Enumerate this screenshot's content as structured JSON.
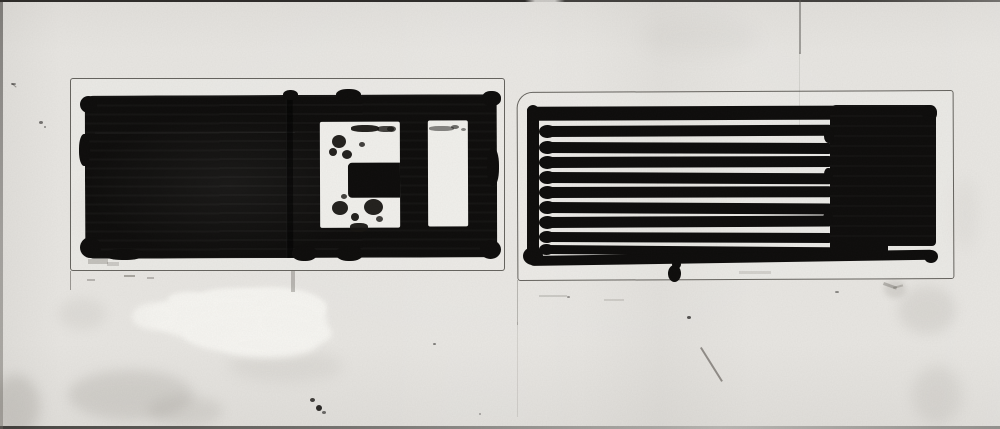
{
  "artwork": {
    "type": "scanned ink drawing",
    "description": "Black ink study on stained paper: two pencil-ruled panels. Left panel is a solid black rectangle with a white bracket-shaped cutout and a white vertical bar. Right panel is a comb of eleven horizontal ink stripes with a solid black block at the right end. White-out splotch and gray smudges below the left panel.",
    "colors": {
      "paper": "#e8e6e2",
      "paper_bright": "#f1f0ec",
      "white_out": "#f7f6f2",
      "ink": "#0d0c0b",
      "pencil": "#38352f"
    },
    "crease": {
      "x": 799,
      "y": 0,
      "w": 2,
      "h": 54
    },
    "left_panel": {
      "pencil_box": {
        "x": 70,
        "y": 78,
        "w": 435,
        "h": 193
      },
      "ink_rect": {
        "x": 85,
        "y": 95,
        "w": 412,
        "h": 163,
        "tilt": -0.2
      },
      "cutout_bracket": {
        "x": 235,
        "y": 27,
        "w": 80,
        "h": 106
      },
      "cutout_bracket_notch": {
        "x": 28,
        "y": 41,
        "w": 52,
        "h": 35
      },
      "cutout_bar": {
        "x": 343,
        "y": 26,
        "w": 40,
        "h": 106
      },
      "seam": {
        "x": 201,
        "y": 0,
        "w": 7,
        "h": 163
      },
      "seam_highlight": {
        "x": 10,
        "y": 37,
        "w": 200,
        "h": 1
      }
    },
    "right_panel": {
      "pencil_box": {
        "x": 517,
        "y": 91,
        "w": 437,
        "h": 189
      },
      "vertical_bar": {
        "x": 527,
        "y": 105,
        "w": 12,
        "h": 158
      },
      "top_stripe": {
        "x": 527,
        "y": 106,
        "w": 409,
        "h": 14,
        "tilt": -0.2
      },
      "block": {
        "x": 830,
        "y": 105,
        "w": 106,
        "h": 141
      },
      "bottom_stripe": {
        "x": 529,
        "y": 256,
        "w": 406,
        "h": 10,
        "tilt": -0.9
      },
      "stripe_x": 542,
      "stripe_w": 292,
      "stripe_count_total": 11,
      "stripes": [
        {
          "y": 126,
          "h": 11,
          "tilt": -0.25
        },
        {
          "y": 142,
          "h": 11,
          "tilt": 0.2
        },
        {
          "y": 157,
          "h": 11,
          "tilt": -0.2
        },
        {
          "y": 172,
          "h": 11,
          "tilt": 0.25
        },
        {
          "y": 187,
          "h": 11,
          "tilt": -0.15
        },
        {
          "y": 202,
          "h": 11,
          "tilt": 0.3
        },
        {
          "y": 217,
          "h": 11,
          "tilt": -0.3
        },
        {
          "y": 232,
          "h": 10,
          "tilt": 0.2
        },
        {
          "y": 245,
          "h": 9,
          "tilt": 0.45
        }
      ]
    },
    "ink_marks": [
      {
        "x": 80,
        "y": 96,
        "w": 17,
        "h": 17
      },
      {
        "x": 79,
        "y": 134,
        "w": 11,
        "h": 32,
        "r": "45%"
      },
      {
        "x": 80,
        "y": 237,
        "w": 21,
        "h": 21
      },
      {
        "x": 104,
        "y": 249,
        "w": 40,
        "h": 11,
        "r": "45%"
      },
      {
        "x": 283,
        "y": 90,
        "w": 15,
        "h": 10,
        "r": "45%"
      },
      {
        "x": 336,
        "y": 89,
        "w": 25,
        "h": 12,
        "r": "45%"
      },
      {
        "x": 482,
        "y": 91,
        "w": 19,
        "h": 15,
        "r": "45%"
      },
      {
        "x": 487,
        "y": 148,
        "w": 12,
        "h": 38,
        "r": "45%"
      },
      {
        "x": 480,
        "y": 240,
        "w": 21,
        "h": 19
      },
      {
        "x": 292,
        "y": 246,
        "w": 25,
        "h": 15,
        "r": "45%"
      },
      {
        "x": 336,
        "y": 246,
        "w": 27,
        "h": 15,
        "r": "45%"
      },
      {
        "x": 523,
        "y": 247,
        "w": 20,
        "h": 18
      },
      {
        "x": 922,
        "y": 105,
        "w": 15,
        "h": 16,
        "r": "45%"
      },
      {
        "x": 924,
        "y": 250,
        "w": 14,
        "h": 13
      },
      {
        "x": 824,
        "y": 128,
        "w": 10,
        "h": 15,
        "r": "45%"
      },
      {
        "x": 824,
        "y": 168,
        "w": 9,
        "h": 13,
        "r": "45%"
      },
      {
        "x": 823,
        "y": 212,
        "w": 10,
        "h": 13,
        "r": "45%"
      },
      {
        "x": 830,
        "y": 240,
        "w": 58,
        "h": 17,
        "r": "3px"
      },
      {
        "x": 668,
        "y": 265,
        "w": 13,
        "h": 17
      },
      {
        "x": 672,
        "y": 260,
        "w": 9,
        "h": 9
      }
    ],
    "specks": [
      {
        "x": 351,
        "y": 125,
        "w": 28,
        "h": 7,
        "r": "40%"
      },
      {
        "x": 377,
        "y": 126,
        "w": 17,
        "h": 6,
        "r": "40%",
        "o": 0.8
      },
      {
        "x": 332,
        "y": 135,
        "w": 14,
        "h": 13
      },
      {
        "x": 329,
        "y": 148,
        "w": 8,
        "h": 8
      },
      {
        "x": 342,
        "y": 150,
        "w": 10,
        "h": 9
      },
      {
        "x": 359,
        "y": 142,
        "w": 6,
        "h": 5,
        "o": 0.8
      },
      {
        "x": 387,
        "y": 126,
        "w": 9,
        "h": 6,
        "o": 0.75
      },
      {
        "x": 332,
        "y": 201,
        "w": 16,
        "h": 14
      },
      {
        "x": 364,
        "y": 199,
        "w": 19,
        "h": 16
      },
      {
        "x": 351,
        "y": 213,
        "w": 8,
        "h": 8
      },
      {
        "x": 341,
        "y": 194,
        "w": 6,
        "h": 5,
        "o": 0.8
      },
      {
        "x": 376,
        "y": 216,
        "w": 7,
        "h": 6,
        "o": 0.8
      },
      {
        "x": 350,
        "y": 223,
        "w": 18,
        "h": 9,
        "r": "40%"
      },
      {
        "x": 429,
        "y": 126,
        "w": 25,
        "h": 5,
        "r": "40%",
        "o": 0.5
      },
      {
        "x": 451,
        "y": 125,
        "w": 8,
        "h": 4,
        "o": 0.6
      },
      {
        "x": 461,
        "y": 128,
        "w": 5,
        "h": 3,
        "o": 0.5
      },
      {
        "x": 310,
        "y": 398,
        "w": 5,
        "h": 4,
        "o": 0.8
      },
      {
        "x": 316,
        "y": 405,
        "w": 6,
        "h": 6,
        "o": 0.9
      },
      {
        "x": 322,
        "y": 411,
        "w": 4,
        "h": 3,
        "o": 0.6
      },
      {
        "x": 433,
        "y": 343,
        "w": 3,
        "h": 2,
        "o": 0.5
      },
      {
        "x": 687,
        "y": 316,
        "w": 4,
        "h": 3,
        "o": 0.7
      },
      {
        "x": 835,
        "y": 291,
        "w": 4,
        "h": 2,
        "o": 0.45
      },
      {
        "x": 567,
        "y": 296,
        "w": 3,
        "h": 2,
        "o": 0.4
      },
      {
        "x": 39,
        "y": 121,
        "w": 4,
        "h": 3,
        "o": 0.55
      },
      {
        "x": 44,
        "y": 126,
        "w": 2,
        "h": 2,
        "o": 0.45
      },
      {
        "x": 11,
        "y": 83,
        "w": 5,
        "h": 2,
        "o": 0.5
      },
      {
        "x": 479,
        "y": 413,
        "w": 2,
        "h": 2,
        "o": 0.35
      }
    ],
    "pencil_marks": [
      {
        "x": 700,
        "y": 348,
        "w": 2,
        "h": 40,
        "rot": -32,
        "o": 0.55
      },
      {
        "x": 124,
        "y": 275,
        "w": 11,
        "h": 2,
        "o": 0.4
      },
      {
        "x": 147,
        "y": 277,
        "w": 7,
        "h": 2,
        "o": 0.3
      },
      {
        "x": 87,
        "y": 279,
        "w": 8,
        "h": 2,
        "o": 0.3
      },
      {
        "x": 88,
        "y": 259,
        "w": 20,
        "h": 5,
        "o": 0.25
      },
      {
        "x": 107,
        "y": 262,
        "w": 12,
        "h": 4,
        "o": 0.2
      },
      {
        "x": 291,
        "y": 271,
        "w": 4,
        "h": 21,
        "o": 0.3
      },
      {
        "x": 739,
        "y": 271,
        "w": 32,
        "h": 3,
        "o": 0.15
      },
      {
        "x": 539,
        "y": 295,
        "w": 28,
        "h": 2,
        "o": 0.18
      },
      {
        "x": 604,
        "y": 299,
        "w": 20,
        "h": 2,
        "o": 0.15
      },
      {
        "x": 70,
        "y": 271,
        "w": 1,
        "h": 19,
        "o": 0.5
      },
      {
        "x": 517,
        "y": 280,
        "w": 1,
        "h": 45,
        "o": 0.3
      },
      {
        "x": 517,
        "y": 322,
        "w": 1,
        "h": 95,
        "o": 0.13
      },
      {
        "x": 799,
        "y": 52,
        "w": 1,
        "h": 75,
        "o": 0.12
      },
      {
        "x": 12,
        "y": 83,
        "w": 6,
        "h": 1,
        "rot": 40,
        "o": 0.5
      },
      {
        "x": 884,
        "y": 282,
        "w": 14,
        "h": 3,
        "rot": 20,
        "o": 0.3
      },
      {
        "x": 893,
        "y": 287,
        "w": 10,
        "h": 2,
        "rot": -15,
        "o": 0.25
      }
    ],
    "stains": [
      {
        "x": 68,
        "y": 370,
        "w": 125,
        "h": 50,
        "c": "#8a867f",
        "o": 0.2,
        "b": 6
      },
      {
        "x": 148,
        "y": 396,
        "w": 75,
        "h": 30,
        "c": "#8a867f",
        "o": 0.16,
        "b": 6
      },
      {
        "x": -8,
        "y": 375,
        "w": 48,
        "h": 62,
        "c": "#8a867f",
        "o": 0.24,
        "b": 6
      },
      {
        "x": 228,
        "y": 350,
        "w": 115,
        "h": 32,
        "c": "#8a867f",
        "o": 0.1,
        "b": 7
      },
      {
        "x": 898,
        "y": 286,
        "w": 58,
        "h": 48,
        "c": "#8a867f",
        "o": 0.14,
        "b": 6
      },
      {
        "x": 912,
        "y": 366,
        "w": 50,
        "h": 58,
        "c": "#8a867f",
        "o": 0.13,
        "b": 7
      },
      {
        "x": 952,
        "y": 178,
        "w": 26,
        "h": 72,
        "c": "#8a867f",
        "o": 0.07,
        "b": 8
      },
      {
        "x": 884,
        "y": 280,
        "w": 22,
        "h": 18,
        "c": "#8a867f",
        "o": 0.2,
        "b": 3
      },
      {
        "x": 58,
        "y": 298,
        "w": 48,
        "h": 32,
        "c": "#8a867f",
        "o": 0.1,
        "b": 6
      },
      {
        "x": 640,
        "y": 18,
        "w": 120,
        "h": 40,
        "c": "#8a867f",
        "o": 0.05,
        "b": 9
      },
      {
        "x": 80,
        "y": 180,
        "w": 30,
        "h": 60,
        "c": "#8a867f",
        "o": 0.07,
        "b": 8
      },
      {
        "x": 148,
        "y": 294,
        "w": 125,
        "h": 45,
        "c": "#f7f6f2",
        "o": 0.95,
        "b": 3
      },
      {
        "x": 212,
        "y": 287,
        "w": 115,
        "h": 42,
        "c": "#f7f6f2",
        "o": 0.97,
        "b": 2
      },
      {
        "x": 182,
        "y": 312,
        "w": 150,
        "h": 42,
        "c": "#f7f6f2",
        "o": 0.97,
        "b": 3
      },
      {
        "x": 255,
        "y": 298,
        "w": 72,
        "h": 48,
        "c": "#f7f6f2",
        "o": 0.9,
        "b": 3
      },
      {
        "x": 132,
        "y": 303,
        "w": 45,
        "h": 27,
        "c": "#f7f6f2",
        "o": 0.85,
        "b": 3
      },
      {
        "x": 222,
        "y": 330,
        "w": 95,
        "h": 28,
        "c": "#f7f6f2",
        "o": 0.9,
        "b": 4
      },
      {
        "x": 200,
        "y": 288,
        "w": 65,
        "h": 16,
        "c": "#f7f6f2",
        "o": 0.9,
        "b": 2
      },
      {
        "x": 168,
        "y": 292,
        "w": 40,
        "h": 14,
        "c": "#f7f6f2",
        "o": 0.85,
        "b": 2
      }
    ]
  }
}
